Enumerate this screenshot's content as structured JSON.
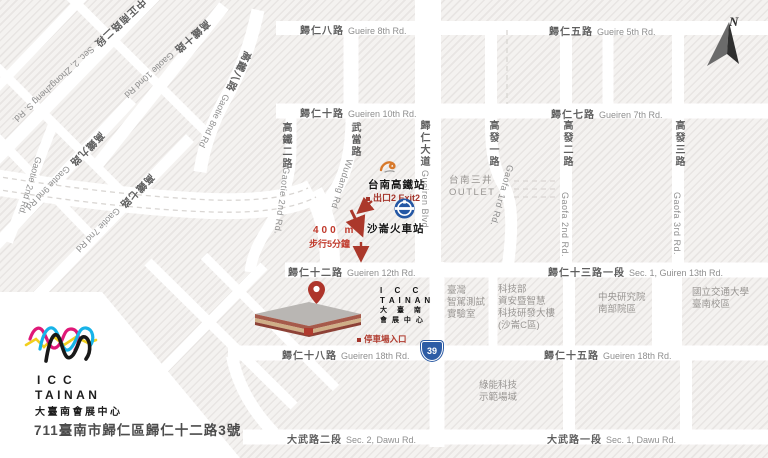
{
  "map": {
    "roads": {
      "gueire8": {
        "zh": "歸仁八路",
        "en": "Gueire 8th Rd."
      },
      "gueire5": {
        "zh": "歸仁五路",
        "en": "Gueire 5th Rd."
      },
      "gueiren10": {
        "zh": "歸仁十路",
        "en": "Gueiren 10th Rd."
      },
      "gueiren7": {
        "zh": "歸仁七路",
        "en": "Gueiren 7th Rd."
      },
      "gueiren12": {
        "zh": "歸仁十二路",
        "en": "Gueiren 12th Rd."
      },
      "guiren13": {
        "zh": "歸仁十三路一段",
        "en": "Sec. 1, Guiren 13th Rd."
      },
      "gueiren18": {
        "zh": "歸仁十八路",
        "en": "Gueiren 18th Rd."
      },
      "gueiren15": {
        "zh": "歸仁十五路",
        "en": "Gueiren 18th Rd."
      },
      "dawu2": {
        "zh": "大武路二段",
        "en": "Sec. 2, Dawu Rd."
      },
      "dawu1": {
        "zh": "大武路一段",
        "en": "Sec. 1, Dawu Rd."
      },
      "gueiren_blvd": {
        "zh": "歸仁大道",
        "en": "Gueiren Blvd."
      },
      "wudang": {
        "zh": "武當路",
        "en": "Wudang Rd"
      },
      "gaofa1": {
        "zh": "高發一路",
        "en": "Gaofa 1rd Rd."
      },
      "gaofa2": {
        "zh": "高發二路",
        "en": "Gaofa 2nd Rd."
      },
      "gaofa3": {
        "zh": "高發三路",
        "en": "Gaofa 3rd Rd."
      },
      "gaotie2": {
        "zh": "高鐵二路",
        "en": "Gaotie 2nd Rd."
      },
      "zhongzheng": {
        "zh": "中正南路二段",
        "en": "Sec. 2, Zhongzheng S. Rd."
      },
      "gaotie10": {
        "zh": "高鐵十路",
        "en": "Gaotie 10nd Rd"
      },
      "gaotie9": {
        "zh": "高鐵九路",
        "en": "Gaotie 9nd Rd"
      },
      "gaotie7": {
        "zh": "高鐵七路",
        "en": "Gaotie 7nd Rd"
      },
      "gaotie8": {
        "zh": "高鐵八路",
        "en": "Gaotie 8nd Rd"
      }
    },
    "stations": {
      "hsr": {
        "name": "台南高鐵站",
        "exit": "出口2 Exit2"
      },
      "tra": {
        "name": "沙崙火車站"
      }
    },
    "route": {
      "distance": "400 m",
      "duration": "步行5分鐘"
    },
    "places": {
      "outlet": {
        "zh": "台南三井",
        "en": "OUTLET"
      },
      "car_lab": {
        "lines": [
          "臺灣",
          "智駕測試",
          "實驗室"
        ]
      },
      "most": {
        "lines": [
          "科技部",
          "資安暨智慧",
          "科技研發大樓",
          "(沙崙C區)"
        ]
      },
      "sinica": {
        "lines": [
          "中央研究院",
          "南部院區"
        ]
      },
      "nctu": {
        "lines": [
          "國立交通大學",
          "臺南校區"
        ]
      },
      "green": {
        "lines": [
          "綠能科技",
          "示範場域"
        ]
      }
    },
    "icc": {
      "lockup": [
        "I C C",
        "T A I N A N",
        "大 臺 南",
        "會 展 中 心"
      ],
      "parking": "停車場入口"
    },
    "highway": {
      "number": "39"
    },
    "compass": {
      "label": "N"
    }
  },
  "brand": {
    "line1": "ICC",
    "line2": "TAINAN",
    "subtitle": "大臺南會展中心",
    "address": "711臺南市歸仁區歸仁十二路3號",
    "colors": {
      "cyan": "#17b3e8",
      "magenta": "#df1878",
      "yellow": "#f2cf1d",
      "black": "#191919",
      "red": "#b03a2c",
      "blue": "#2d5ca5"
    }
  }
}
